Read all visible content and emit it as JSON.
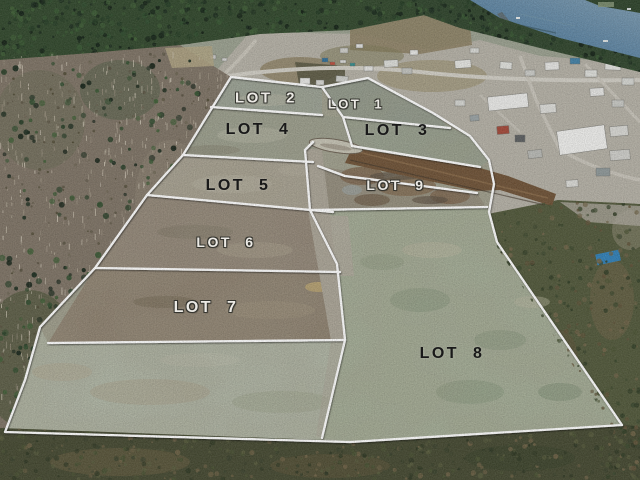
{
  "image": {
    "caption": "Aerial drone photo of a cleared nine-lot land subdivision beside a coastal town and harbour, bordered by forest"
  },
  "overlay": {
    "line_color": "#ffffff",
    "light_label_color": "#eceae5",
    "dark_label_color": "#191919"
  },
  "scene_colors": {
    "water": "#4d7b9e",
    "conifer_forest": "#2b4429",
    "bare_forest": "#7d7264",
    "cleared_land": "#a3a292",
    "lot8_grass": "#a7b299",
    "road_corridor_rust": "#6d5034",
    "town_ground": "#b5b1a6",
    "scrub": "#464c30"
  },
  "lots": [
    {
      "label": "LOT 1",
      "tone": "light"
    },
    {
      "label": "LOT 2",
      "tone": "light"
    },
    {
      "label": "LOT 3",
      "tone": "dark"
    },
    {
      "label": "LOT 4",
      "tone": "dark"
    },
    {
      "label": "LOT 5",
      "tone": "dark"
    },
    {
      "label": "LOT 6",
      "tone": "light"
    },
    {
      "label": "LOT 7",
      "tone": "light"
    },
    {
      "label": "LOT 8",
      "tone": "dark"
    },
    {
      "label": "LOT 9",
      "tone": "light"
    }
  ]
}
